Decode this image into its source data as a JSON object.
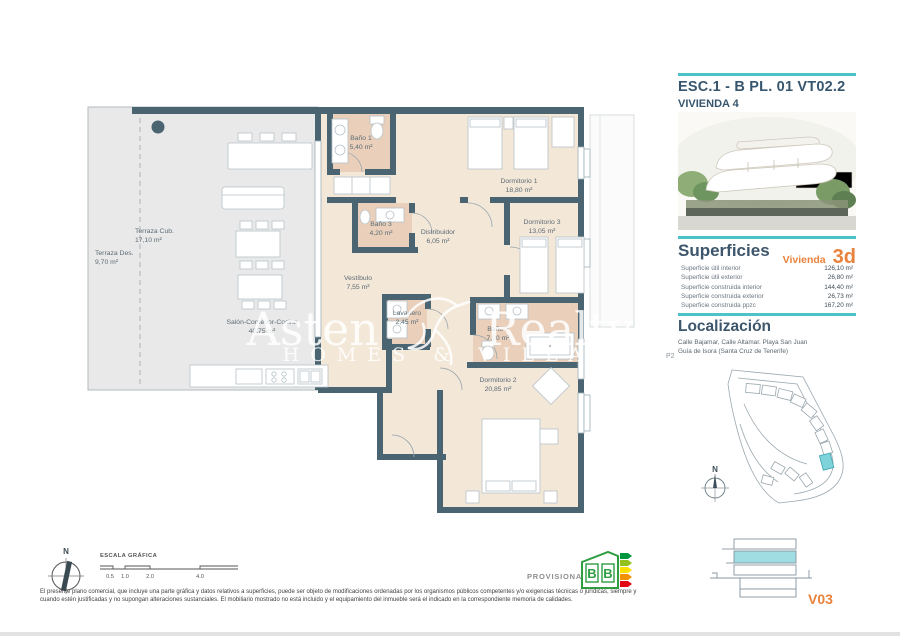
{
  "plan": {
    "rooms": [
      {
        "name": "Terraza Cub.",
        "area": "17,10 m²"
      },
      {
        "name": "Terraza Des.",
        "area": "9,70 m²"
      },
      {
        "name": "Baño 1",
        "area": "5,40 m²"
      },
      {
        "name": "Dormitorio 1",
        "area": "18,80 m²"
      },
      {
        "name": "Baño 3",
        "area": "4,20 m²"
      },
      {
        "name": "Distribuidor",
        "area": "6,05 m²"
      },
      {
        "name": "Dormitorio 3",
        "area": "13,05 m²"
      },
      {
        "name": "Vestíbulo",
        "area": "7,55 m²"
      },
      {
        "name": "Salón-Comedor-Cocina",
        "area": "40,75 m²"
      },
      {
        "name": "Lavadero",
        "area": "2,45 m²"
      },
      {
        "name": "Baño 2",
        "area": "7,00 m²"
      },
      {
        "name": "Dormitorio 2",
        "area": "20,85 m²"
      }
    ],
    "watermark": {
      "brand_left": "Asten",
      "brand_right": "Realty",
      "tagline": "HOMES & VILLAS"
    }
  },
  "sidebar": {
    "code": "ESC.1 - B  PL. 01 VT02.2",
    "unit": "VIVIENDA 4",
    "superficies": {
      "title": "Superficies",
      "tag": "Vivienda",
      "tag_value": "3d",
      "rows": [
        {
          "label": "Superficie útil interior",
          "value": "126,10 m²"
        },
        {
          "label": "Superficie útil exterior",
          "value": "26,80 m²"
        },
        {
          "label": "Superficie construida interior",
          "value": "144,40 m²"
        },
        {
          "label": "Superficie construida exterior",
          "value": "26,73 m²"
        },
        {
          "label": "Superficie construida ppzc",
          "value": "167,20 m²"
        }
      ]
    },
    "localizacion": {
      "title": "Localización",
      "address_line1": "Calle Bajamar, Calle Altamar. Playa San Juan",
      "address_line2": "Guía de Isora (Santa Cruz de Tenerife)"
    },
    "plan_ref": "P2",
    "version": "V03"
  },
  "footer": {
    "north": "N",
    "scale_label": "ESCALA GRÁFICA",
    "scale_ticks": [
      "0.5",
      "1.0",
      "2.0",
      "4.0"
    ],
    "provisional": "PROVISIONAL",
    "energy_letters": [
      "B",
      "B"
    ],
    "disclaimer_line1": "El presente plano comercial, que incluye una parte gráfica y datos relativos a superficies, puede ser objeto de modificaciones ordenadas por los organismos públicos competentes y/o exigencias técnicas o jurídicas, siempre y",
    "disclaimer_line2": "cuando estén justificadas y no supongan alteraciones sustanciales. El mobiliario mostrado no está incluido y el equipamiento del inmueble será el indicado en la correspondiente memoria de calidades."
  },
  "colors": {
    "teal": "#4cc3c6",
    "navy": "#3d566b",
    "orange": "#e8823c",
    "wall": "#4a6472"
  }
}
